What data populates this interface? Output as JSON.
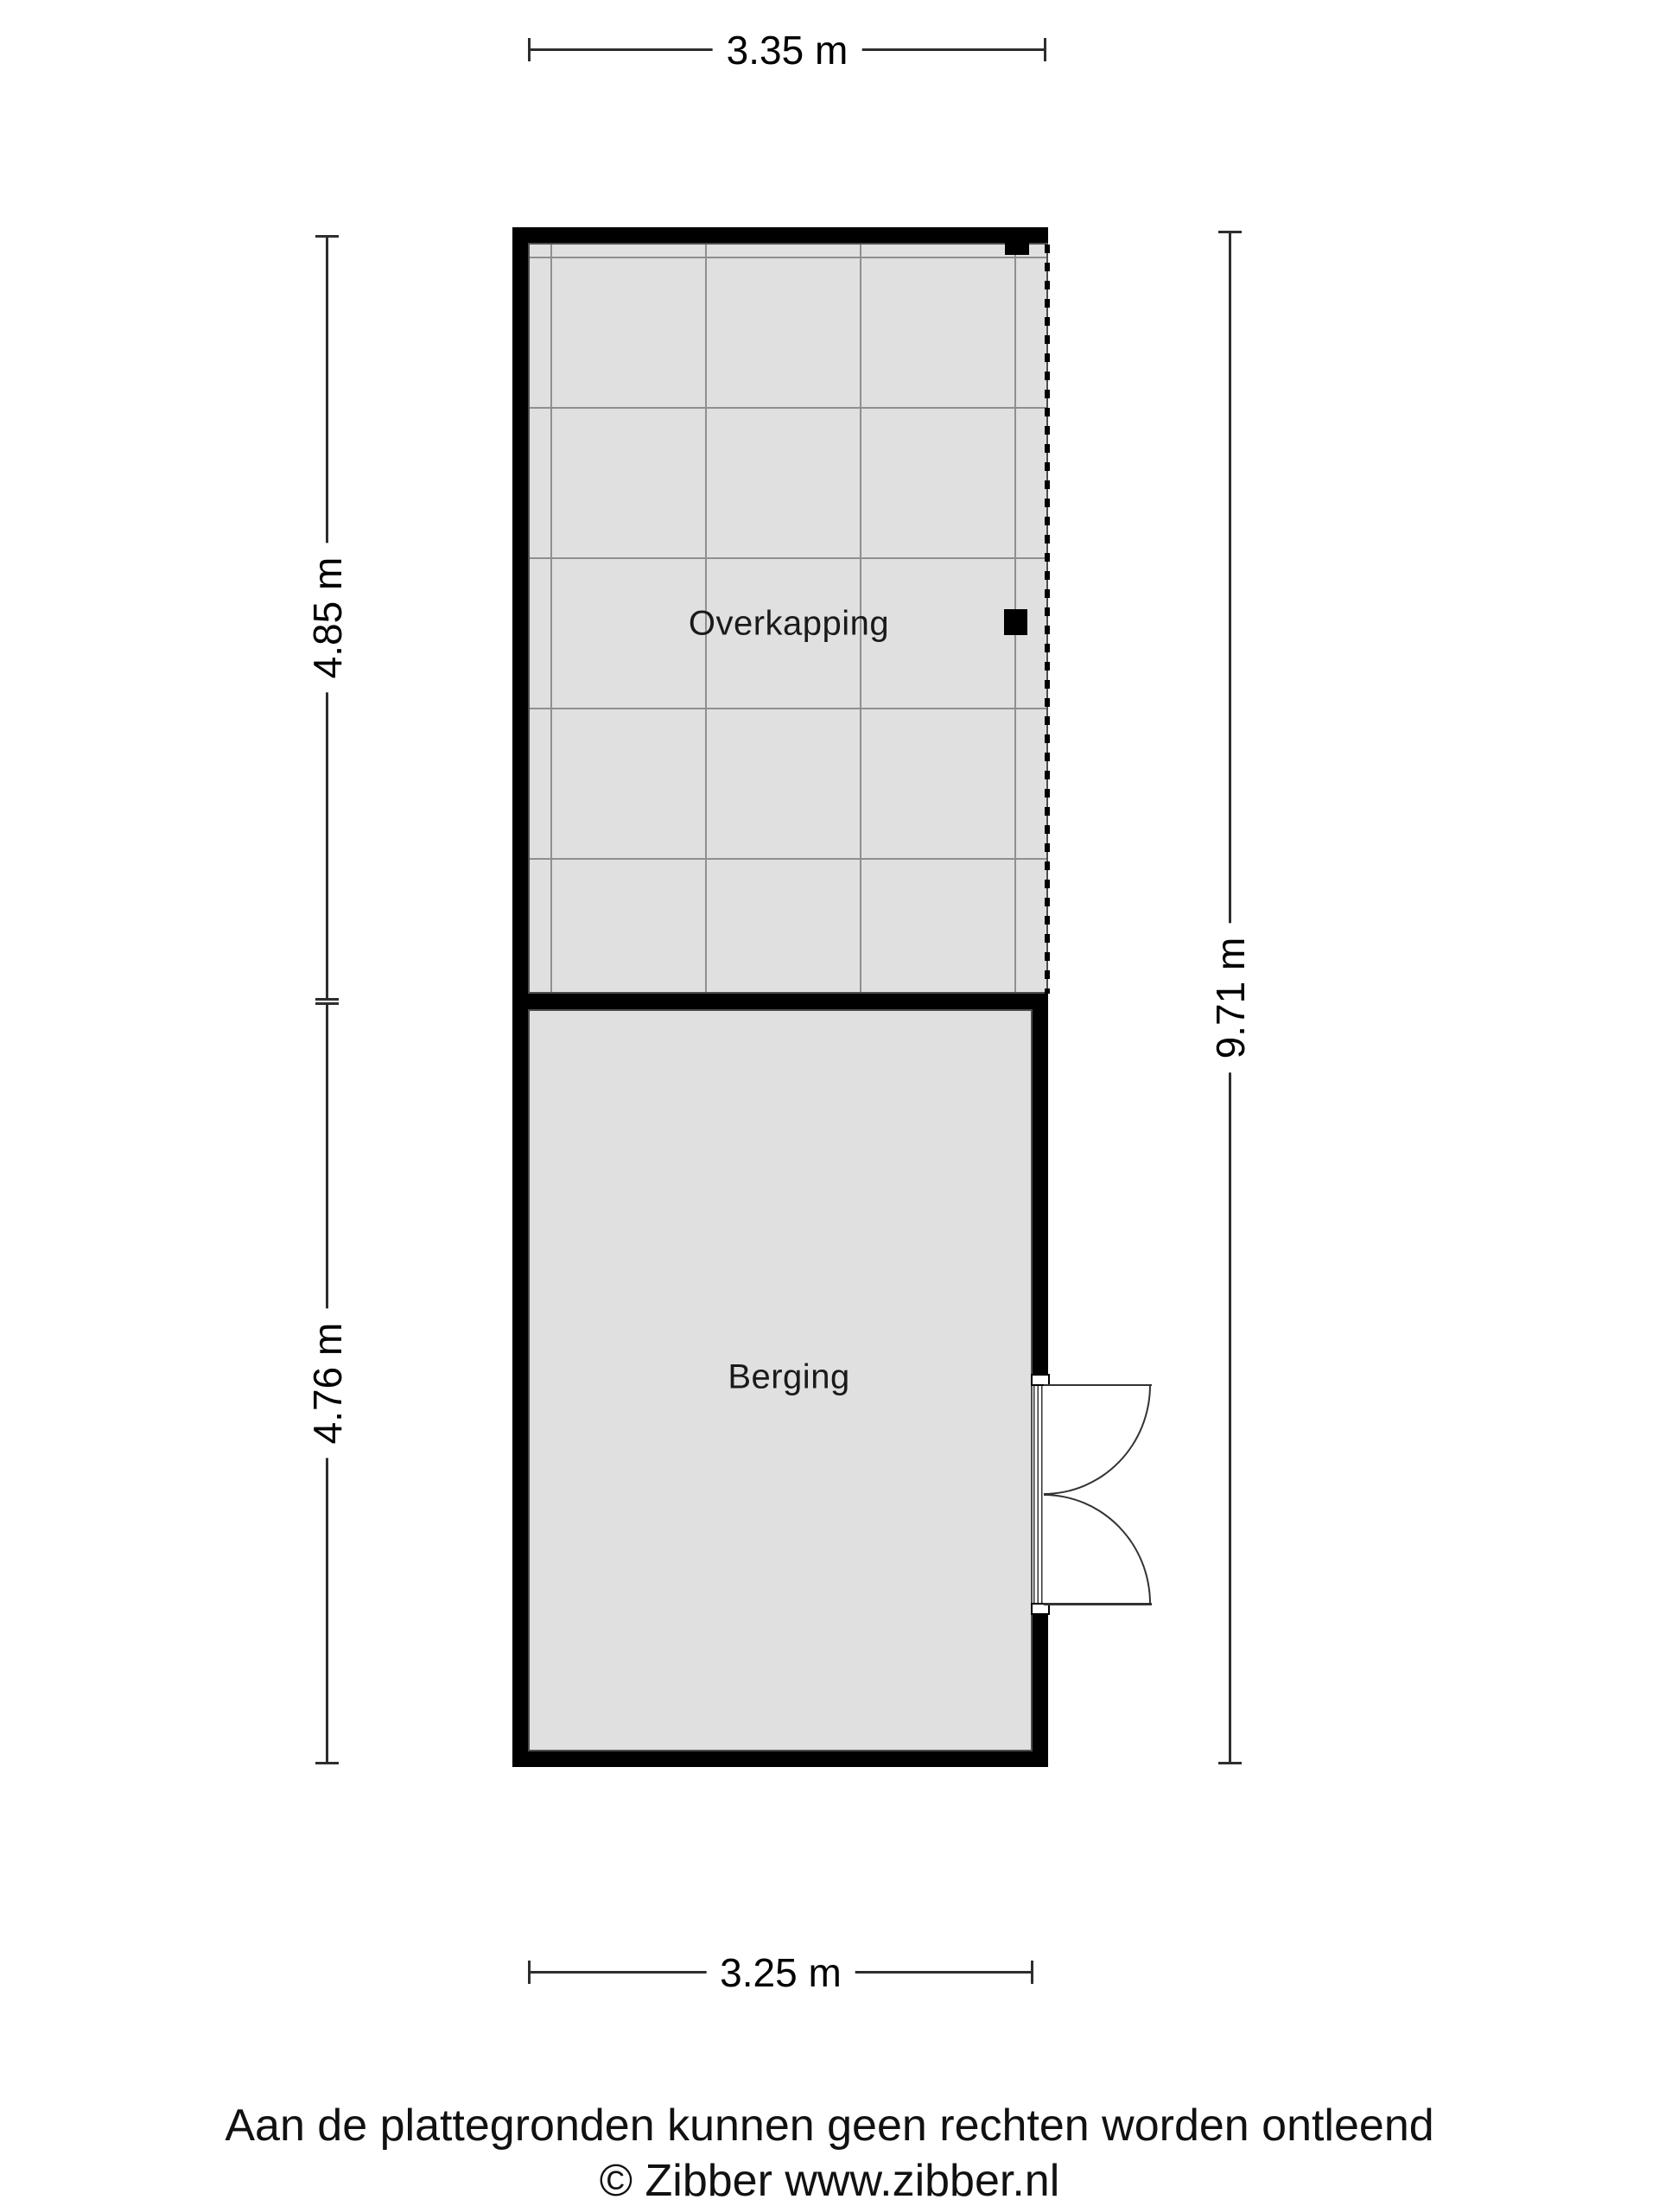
{
  "plan": {
    "rooms": {
      "overkapping": {
        "label": "Overkapping"
      },
      "berging": {
        "label": "Berging"
      }
    },
    "dimensions": {
      "top": "3.35 m",
      "left_upper": "4.85 m",
      "left_lower": "4.76 m",
      "right": "9.71 m",
      "bottom": "3.25 m"
    },
    "colors": {
      "wall": "#000000",
      "room_fill": "#e0e0e0",
      "grid_line": "#8f8f8f",
      "room_outline": "#4d4d4d",
      "dimension_line": "#2e2e2e"
    }
  },
  "footer": {
    "disclaimer": "Aan de plattegronden kunnen geen rechten worden ontleend",
    "copyright": "© Zibber www.zibber.nl"
  }
}
